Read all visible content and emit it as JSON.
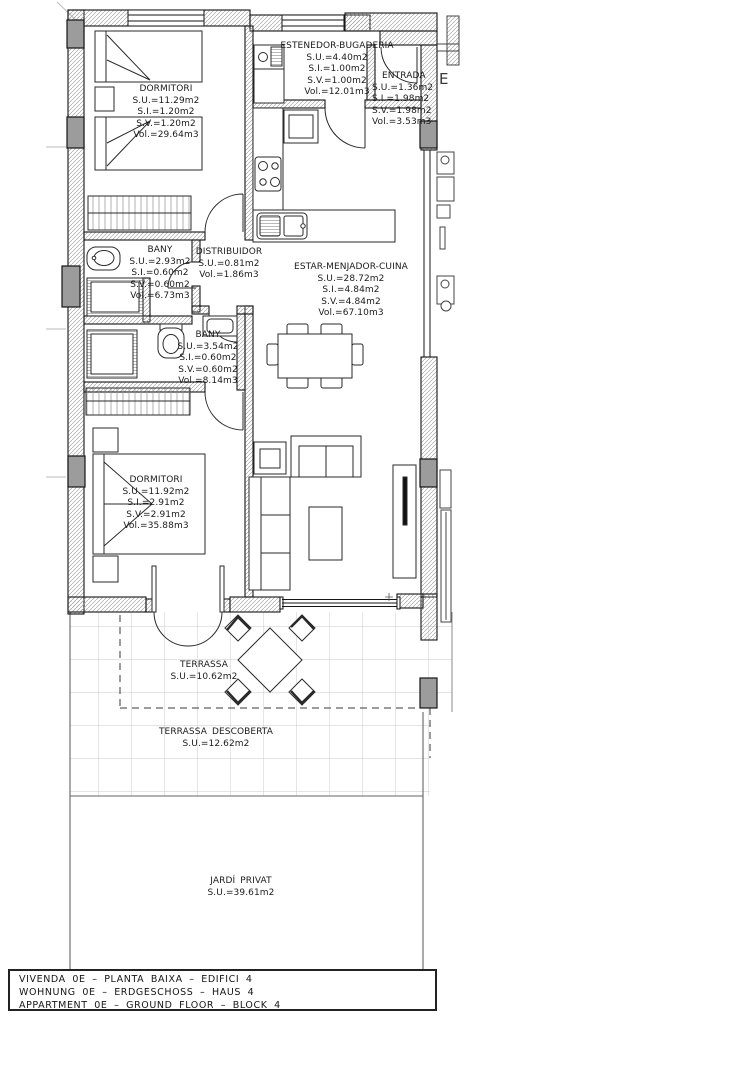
{
  "rooms": [
    {
      "id": "dormitori-1",
      "name": "DORMITORI",
      "lines": [
        "S.U.=11.29m2",
        "S.I.=1.20m2",
        "S.V.=1.20m2",
        "Vol.=29.64m3"
      ]
    },
    {
      "id": "estenedor-bugaderia",
      "name": "ESTENEDOR-BUGADERIA",
      "lines": [
        "S.U.=4.40m2",
        "S.I.=1.00m2",
        "S.V.=1.00m2",
        "Vol.=12.01m3"
      ]
    },
    {
      "id": "entrada",
      "name": "ENTRADA",
      "lines": [
        "S.U.=1.36m2",
        "S.I.=1.98m2",
        "S.V.=1.98m2",
        "Vol.=3.53m3"
      ]
    },
    {
      "id": "bany-1",
      "name": "BANY",
      "lines": [
        "S.U.=2.93m2",
        "S.I.=0.60m2",
        "S.V.=0.60m2",
        "Vol.=6.73m3"
      ]
    },
    {
      "id": "distribuidor",
      "name": "DISTRIBUIDOR",
      "lines": [
        "S.U.=0.81m2",
        "Vol.=1.86m3"
      ]
    },
    {
      "id": "estar-menjador-cuina",
      "name": "ESTAR-MENJADOR-CUINA",
      "lines": [
        "S.U.=28.72m2",
        "S.I.=4.84m2",
        "S.V.=4.84m2",
        "Vol.=67.10m3"
      ]
    },
    {
      "id": "bany-2",
      "name": "BANY",
      "lines": [
        "S.U.=3.54m2",
        "S.I.=0.60m2",
        "S.V.=0.60m2",
        "Vol.=8.14m3"
      ]
    },
    {
      "id": "dormitori-2",
      "name": "DORMITORI",
      "lines": [
        "S.U.=11.92m2",
        "S.I.=2.91m2",
        "S.V.=2.91m2",
        "Vol.=35.88m3"
      ]
    },
    {
      "id": "terrassa",
      "name": "TERRASSA",
      "lines": [
        "S.U.=10.62m2"
      ]
    },
    {
      "id": "terrassa-descoberta",
      "name": "TERRASSA DESCOBERTA",
      "lines": [
        "S.U.=12.62m2"
      ]
    },
    {
      "id": "jardi-privat",
      "name": "JARDÍ PRIVAT",
      "lines": [
        "S.U.=39.61m2"
      ]
    }
  ],
  "adjacent": {
    "label": "E"
  },
  "title_block": {
    "lines": [
      "VIVENDA 0E – PLANTA BAIXA – EDIFICI 4",
      "WOHNUNG 0E – ERDGESCHOSS – HAUS 4",
      "APPARTMENT 0E – GROUND FLOOR – BLOCK 4"
    ]
  },
  "colors": {
    "pillar": "#9c9c9c",
    "wall_line": "#151515",
    "tile_line": "#c9c9c9",
    "dash_line": "#3a3a3a"
  }
}
